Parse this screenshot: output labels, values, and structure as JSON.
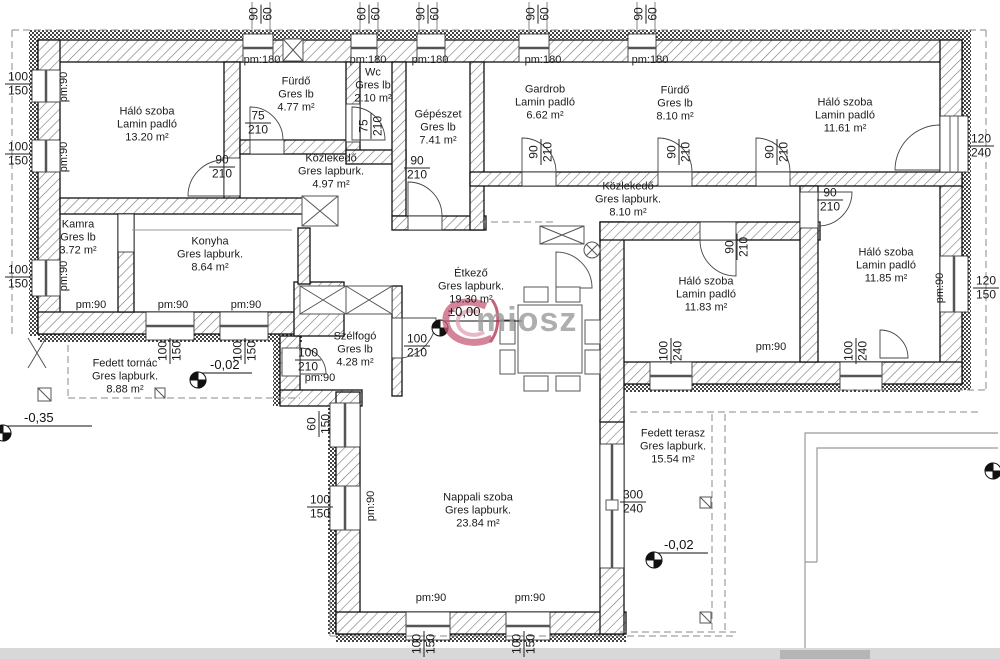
{
  "drawing": {
    "type": "architectural floor plan"
  },
  "watermark": {
    "text": "miosz",
    "accent": "#c75d78",
    "gray": "#9a9a9a"
  },
  "rooms": [
    {
      "name": "Háló szoba",
      "floor": "Lamin padló",
      "area": "13.20 m²"
    },
    {
      "name": "Fürdő",
      "floor": "Gres lb",
      "area": "4.77 m²"
    },
    {
      "name": "Wc",
      "floor": "Gres lb",
      "area": "2.10 m²"
    },
    {
      "name": "Gépészet",
      "floor": "Gres lb",
      "area": "7.41 m²"
    },
    {
      "name": "Gardrob",
      "floor": "Lamin padló",
      "area": "6.62 m²"
    },
    {
      "name": "Fürdő",
      "floor": "Gres lb",
      "area": "8.10 m²"
    },
    {
      "name": "Háló szoba",
      "floor": "Lamin padló",
      "area": "11.61 m²"
    },
    {
      "name": "Közlekedő",
      "floor": "Gres lapburk.",
      "area": "4.97 m²"
    },
    {
      "name": "Közlekedő",
      "floor": "Gres lapburk.",
      "area": "8.10 m²"
    },
    {
      "name": "Kamra",
      "floor": "Gres lb",
      "area": "3.72 m²"
    },
    {
      "name": "Konyha",
      "floor": "Gres lapburk.",
      "area": "8.64 m²"
    },
    {
      "name": "Étkező",
      "floor": "Gres lapburk.",
      "area": "19.30 m²"
    },
    {
      "name": "Háló szoba",
      "floor": "Lamin padló",
      "area": "11.83 m²"
    },
    {
      "name": "Háló szoba",
      "floor": "Lamin padló",
      "area": "11.85 m²"
    },
    {
      "name": "Szélfogó",
      "floor": "Gres lb",
      "area": "4.28 m²"
    },
    {
      "name": "Fedett tornác",
      "floor": "Gres lapburk.",
      "area": "8.88 m²"
    },
    {
      "name": "Nappali szoba",
      "floor": "Gres lapburk.",
      "area": "23.84 m²"
    },
    {
      "name": "Fedett terasz",
      "floor": "Gres lapburk.",
      "area": "15.54 m²"
    }
  ],
  "dims": [
    {
      "t": "75",
      "b": "210"
    },
    {
      "t": "90",
      "b": "210"
    },
    {
      "t": "75",
      "b": "210"
    },
    {
      "t": "90",
      "b": "210"
    },
    {
      "t": "90",
      "b": "210"
    },
    {
      "t": "90",
      "b": "210"
    },
    {
      "t": "90",
      "b": "210"
    },
    {
      "t": "120",
      "b": "240"
    },
    {
      "t": "90",
      "b": "210"
    },
    {
      "t": "90",
      "b": "210"
    },
    {
      "t": "100",
      "b": "210"
    },
    {
      "t": "100",
      "b": "210"
    },
    {
      "t": "100",
      "b": "150"
    },
    {
      "t": "100",
      "b": "150"
    },
    {
      "t": "100",
      "b": "150"
    },
    {
      "t": "100",
      "b": "150"
    },
    {
      "t": "100",
      "b": "150"
    },
    {
      "t": "60",
      "b": "150"
    },
    {
      "t": "100",
      "b": "150"
    },
    {
      "t": "100",
      "b": "150"
    },
    {
      "t": "100",
      "b": "150"
    },
    {
      "t": "300",
      "b": "240"
    },
    {
      "t": "100",
      "b": "240"
    },
    {
      "t": "100",
      "b": "240"
    },
    {
      "t": "120",
      "b": "150"
    },
    {
      "t": "90",
      "b": "60"
    },
    {
      "t": "60",
      "b": "60"
    },
    {
      "t": "90",
      "b": "60"
    },
    {
      "t": "90",
      "b": "60"
    },
    {
      "t": "90",
      "b": "60"
    }
  ],
  "pm": [
    "pm:180",
    "pm:180",
    "pm:180",
    "pm:180",
    "pm:180",
    "pm:90",
    "pm:90",
    "pm:90",
    "pm:90",
    "pm:90",
    "pm:90",
    "pm:90",
    "pm:90",
    "pm:90",
    "pm:90",
    "pm:90",
    "pm:90"
  ],
  "levels": [
    "±0,00",
    "-0,02",
    "-0,02",
    "-0,35"
  ]
}
